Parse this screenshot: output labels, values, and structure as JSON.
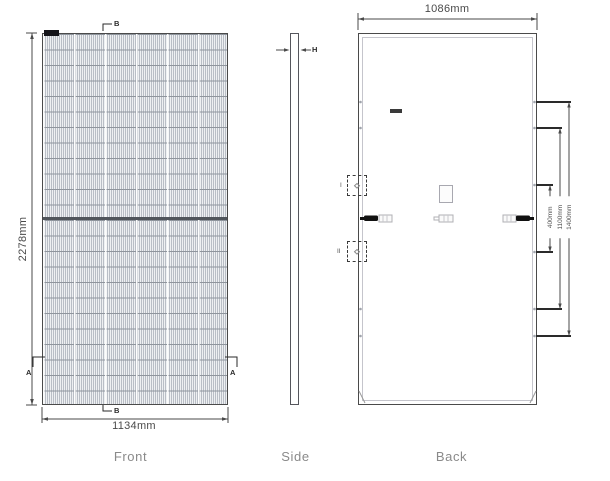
{
  "front": {
    "caption": "Front",
    "height_dim": "2278mm",
    "width_dim": "1134mm",
    "marker_a": "A",
    "marker_b": "B"
  },
  "side": {
    "caption": "Side",
    "thickness_marker": "H"
  },
  "back": {
    "caption": "Back",
    "width_dim": "1086mm",
    "mount_dims": [
      "400mm",
      "1100mm",
      "1400mm"
    ],
    "detail_marker_1": "I",
    "detail_marker_2": "II"
  },
  "colors": {
    "drawing_line": "#4a4a4a",
    "grid_line": "#b9bec6",
    "row_line": "#8f959d",
    "caption_text": "#8a8a8a",
    "connector_black": "#111111"
  }
}
